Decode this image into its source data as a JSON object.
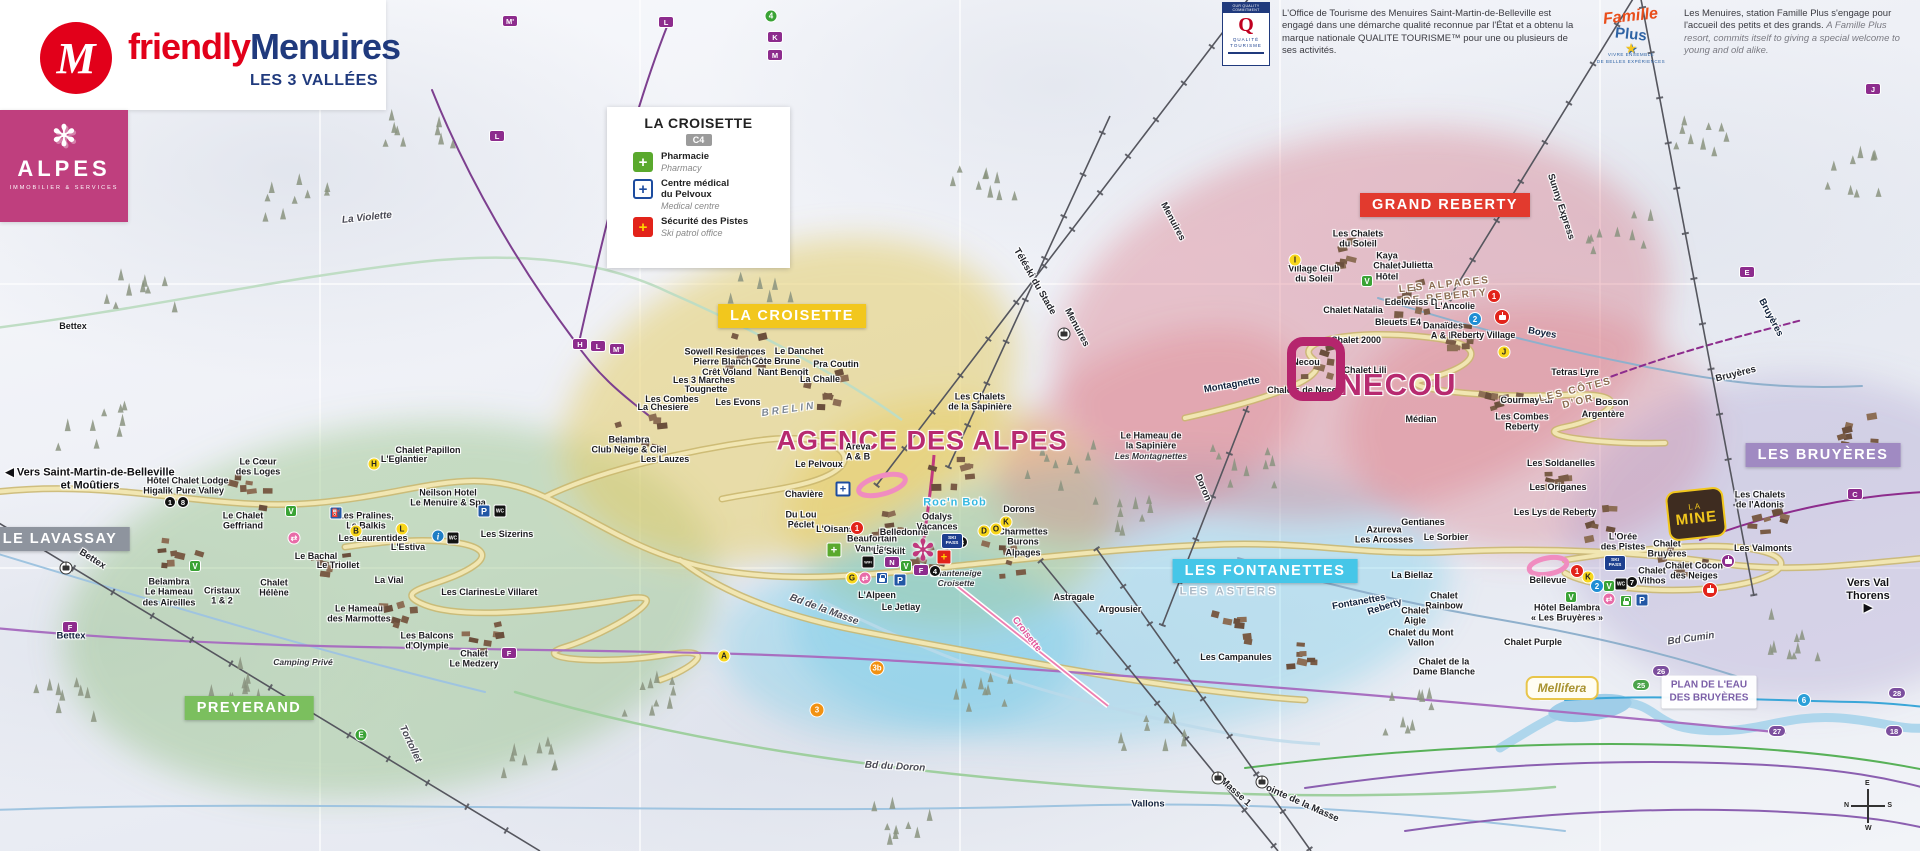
{
  "colors": {
    "brand_red": "#e2001a",
    "brand_blue": "#203a7d",
    "magenta": "#b72a70",
    "alpes_pink": "#bf3f7e",
    "banner_yellow": "#f2c71d",
    "banner_red": "#e23a2e",
    "banner_cyan": "#45c6e8",
    "banner_purple": "#a08ac2",
    "banner_green": "#7bbf5e",
    "banner_gray": "#8e949e",
    "pharmacy_green": "#5aa92d",
    "medical_blue": "#1d4c9f",
    "patrol_red": "#e2231a"
  },
  "brand": {
    "friendly": "friendly",
    "menuires": "Menuires",
    "m_initial": "M",
    "tagline": "LES 3 VALLÉES"
  },
  "alpes_card": {
    "flake": "✻",
    "word": "ALPES",
    "sub": "IMMOBILIER & SERVICES"
  },
  "legend": {
    "title": "LA CROISETTE",
    "grid_ref": "C4",
    "items": [
      {
        "icon": "pharmacy-cross",
        "glyph": "+",
        "fr": "Pharmacie",
        "en": "Pharmacy"
      },
      {
        "icon": "medical-cross",
        "glyph": "+",
        "fr": "Centre médical\ndu Pelvoux",
        "en": "Medical centre"
      },
      {
        "icon": "ski-patrol-cross",
        "glyph": "+",
        "fr": "Sécurité des Pistes",
        "en": "Ski patrol office"
      }
    ]
  },
  "info_qualite": {
    "logo_top": "OUR QUALITY COMMITMENT",
    "logo_q": "Q",
    "logo_name": "QUALITÉ TOURISME",
    "text": "L'Office de Tourisme des Menuires Saint-Martin-de-Belleville est engagé dans une démarche qualité reconnue par l'État et a obtenu la marque nationale QUALITE TOURISME™ pour une ou plusieurs de ses activités."
  },
  "info_famille": {
    "logo_script": "Famille",
    "logo_plus": "Plus",
    "logo_star": "★",
    "logo_sub": "VIVRE ENSEMBLE\nDE BELLES EXPÉRIENCES",
    "text_fr": "Les Menuires, station Famille Plus s'engage pour l'accueil des petits et des grands.",
    "text_en": "A Famille Plus resort, commits itself to giving a special welcome to young and old alike."
  },
  "special": {
    "plan_eau": "PLAN DE L'EAU\nDES BRUYÈRES",
    "mellifera": "Mellifera",
    "la_mine_top": "LA",
    "la_mine_main": "MINE",
    "compass": {
      "top": "E",
      "right": "S",
      "bottom": "W",
      "left": "N"
    },
    "agence_marker": "✻"
  },
  "zone_banners": [
    {
      "t": "LA CROISETTE",
      "x": 792,
      "y": 316,
      "bg": "#f2c71d"
    },
    {
      "t": "GRAND REBERTY",
      "x": 1445,
      "y": 205,
      "bg": "#e23a2e"
    },
    {
      "t": "LES FONTANETTES",
      "x": 1265,
      "y": 571,
      "bg": "#45c6e8"
    },
    {
      "t": "LES BRUYÈRES",
      "x": 1823,
      "y": 455,
      "bg": "#a08ac2"
    },
    {
      "t": "PREYERAND",
      "x": 249,
      "y": 708,
      "bg": "#7bbf5e"
    },
    {
      "t": "LE LAVASSAY",
      "x": 60,
      "y": 539,
      "bg": "#8e949e"
    }
  ],
  "map_labels": [
    {
      "t": "AGENCE DES ALPES",
      "x": 922,
      "y": 441,
      "c": "big",
      "fs": 27
    },
    {
      "t": "NECOU",
      "x": 1398,
      "y": 385,
      "c": "big",
      "fs": 31
    },
    {
      "t": "◀ Vers Saint-Martin-de-Belleville\net Moûtiers",
      "x": 90,
      "y": 479,
      "c": "dir"
    },
    {
      "t": "Vers Val Thorens ▶",
      "x": 1868,
      "y": 596,
      "c": "dir"
    },
    {
      "t": "Hôtel\nHigalik",
      "x": 158,
      "y": 486
    },
    {
      "t": "Chalet Lodge\nPure Valley",
      "x": 200,
      "y": 486
    },
    {
      "t": "Le Cœur\ndes Loges",
      "x": 258,
      "y": 467
    },
    {
      "t": "Chalet Papillon",
      "x": 428,
      "y": 450
    },
    {
      "t": "L'Eglantier",
      "x": 404,
      "y": 459
    },
    {
      "t": "Neilson Hotel\nLe Menuire & Spa",
      "x": 448,
      "y": 498
    },
    {
      "t": "Le Chalet\nGeffriand",
      "x": 243,
      "y": 521
    },
    {
      "t": "Les Pralines,\nLe Balkis",
      "x": 366,
      "y": 521
    },
    {
      "t": "Les Laurentides",
      "x": 373,
      "y": 538
    },
    {
      "t": "L'Estiva",
      "x": 408,
      "y": 547
    },
    {
      "t": "Le Bachal",
      "x": 316,
      "y": 556
    },
    {
      "t": "Le Triollet",
      "x": 338,
      "y": 565
    },
    {
      "t": "La Vial",
      "x": 389,
      "y": 580
    },
    {
      "t": "Les Clarines",
      "x": 468,
      "y": 592
    },
    {
      "t": "Le Villaret",
      "x": 516,
      "y": 592
    },
    {
      "t": "Les Sizerins",
      "x": 507,
      "y": 534
    },
    {
      "t": "Belambra\nLe Hameau\ndes Aireilles",
      "x": 169,
      "y": 592
    },
    {
      "t": "Cristaux\n1 & 2",
      "x": 222,
      "y": 596
    },
    {
      "t": "Chalet\nHélène",
      "x": 274,
      "y": 588
    },
    {
      "t": "Le Hameau\ndes Marmottes",
      "x": 359,
      "y": 614
    },
    {
      "t": "Les Balcons\nd'Olympie",
      "x": 427,
      "y": 641
    },
    {
      "t": "Chalet\nLe Medzery",
      "x": 474,
      "y": 659
    },
    {
      "t": "Camping Privé",
      "x": 303,
      "y": 663,
      "c": "pi"
    },
    {
      "t": "Bettex",
      "x": 73,
      "y": 326
    },
    {
      "t": "Bettex",
      "x": 71,
      "y": 637,
      "c": "piste"
    },
    {
      "t": "Bettex",
      "x": 92,
      "y": 560,
      "c": "lift",
      "r": 32
    },
    {
      "t": "Tortollet",
      "x": 410,
      "y": 744,
      "c": "road",
      "r": 65
    },
    {
      "t": "La Violette",
      "x": 367,
      "y": 218,
      "c": "road",
      "r": -6
    },
    {
      "t": "Sowell Residences\nPierre Blanche",
      "x": 725,
      "y": 357
    },
    {
      "t": "Crêt Voland",
      "x": 727,
      "y": 372
    },
    {
      "t": "Côte Brune",
      "x": 776,
      "y": 361
    },
    {
      "t": "Le Danchet",
      "x": 799,
      "y": 351
    },
    {
      "t": "Nant Benoît",
      "x": 783,
      "y": 372
    },
    {
      "t": "Pra Coutin",
      "x": 836,
      "y": 364
    },
    {
      "t": "La Challe",
      "x": 820,
      "y": 379
    },
    {
      "t": "Les 3 Marches",
      "x": 704,
      "y": 380
    },
    {
      "t": "Tougnette",
      "x": 706,
      "y": 389
    },
    {
      "t": "Les Combes",
      "x": 672,
      "y": 399
    },
    {
      "t": "La Chesiere",
      "x": 663,
      "y": 407
    },
    {
      "t": "Les Evons",
      "x": 738,
      "y": 402
    },
    {
      "t": "BRELIN",
      "x": 789,
      "y": 410,
      "c": "areaGray",
      "r": -8
    },
    {
      "t": "Belambra\nClub Neige & Ciel",
      "x": 629,
      "y": 445
    },
    {
      "t": "Les Lauzes",
      "x": 665,
      "y": 459
    },
    {
      "t": "Le Pelvoux",
      "x": 819,
      "y": 464
    },
    {
      "t": "Areva\nA & B",
      "x": 858,
      "y": 452
    },
    {
      "t": "Chavière",
      "x": 804,
      "y": 494
    },
    {
      "t": "Du Lou\nPéclet",
      "x": 801,
      "y": 520
    },
    {
      "t": "L'Oisans",
      "x": 835,
      "y": 529
    },
    {
      "t": "Beaufortain\nVanoise",
      "x": 872,
      "y": 544
    },
    {
      "t": "Le Skilt",
      "x": 889,
      "y": 551
    },
    {
      "t": "Belledonne",
      "x": 904,
      "y": 532
    },
    {
      "t": "Odalys\nVacances",
      "x": 937,
      "y": 522
    },
    {
      "t": "Dorons",
      "x": 1019,
      "y": 509
    },
    {
      "t": "Charmettes\nBurons\nAlpages",
      "x": 1023,
      "y": 542
    },
    {
      "t": "Chanteneige\nCroisette",
      "x": 956,
      "y": 579,
      "c": "pi"
    },
    {
      "t": "L'Alpeen",
      "x": 877,
      "y": 595
    },
    {
      "t": "Le Jetlay",
      "x": 901,
      "y": 607
    },
    {
      "t": "Roc'n Bob",
      "x": 955,
      "y": 503,
      "c": "fun"
    },
    {
      "t": "Bd de la Masse",
      "x": 824,
      "y": 610,
      "c": "road",
      "r": 20
    },
    {
      "t": "Bd du Doron",
      "x": 895,
      "y": 767,
      "c": "road",
      "r": 3
    },
    {
      "t": "Croisette",
      "x": 1026,
      "y": 635,
      "c": "liftPink",
      "r": 52
    },
    {
      "t": "Menuires",
      "x": 1172,
      "y": 222,
      "c": "lift",
      "r": 62
    },
    {
      "t": "Menuires",
      "x": 1076,
      "y": 328,
      "c": "lift",
      "r": 62
    },
    {
      "t": "Téléski du Stade",
      "x": 1034,
      "y": 282,
      "c": "lift",
      "r": 60
    },
    {
      "t": "Montagnette",
      "x": 1232,
      "y": 386,
      "c": "piste",
      "r": -10
    },
    {
      "t": "Doron",
      "x": 1202,
      "y": 488,
      "c": "lift",
      "r": 67
    },
    {
      "t": "Astragale",
      "x": 1074,
      "y": 597
    },
    {
      "t": "Argousier",
      "x": 1120,
      "y": 609
    },
    {
      "t": "LES ASTERS",
      "x": 1229,
      "y": 592,
      "c": "areaOutline"
    },
    {
      "t": "Les Campanules",
      "x": 1236,
      "y": 657
    },
    {
      "t": "Fontanettes",
      "x": 1359,
      "y": 603,
      "c": "piste",
      "r": -10
    },
    {
      "t": "Reberty",
      "x": 1385,
      "y": 608,
      "c": "piste",
      "r": -18
    },
    {
      "t": "Vallons",
      "x": 1148,
      "y": 805,
      "c": "piste"
    },
    {
      "t": "Masse 1",
      "x": 1235,
      "y": 793,
      "c": "lift",
      "r": 42
    },
    {
      "t": "Pointe de la Masse",
      "x": 1299,
      "y": 803,
      "c": "lift",
      "r": 24
    },
    {
      "t": "Les Chalets\nde la Sapinière",
      "x": 980,
      "y": 402
    },
    {
      "t": "Le Hameau de\nla Sapinière",
      "x": 1151,
      "y": 441
    },
    {
      "t": "Les Montagnettes",
      "x": 1151,
      "y": 457,
      "c": "pi"
    },
    {
      "t": "Les Chalets\ndu Soleil",
      "x": 1358,
      "y": 239
    },
    {
      "t": "Kaya\nChalet\nHôtel",
      "x": 1387,
      "y": 266
    },
    {
      "t": "Julietta",
      "x": 1417,
      "y": 265
    },
    {
      "t": "Village Club\ndu Soleil",
      "x": 1314,
      "y": 274
    },
    {
      "t": "LES ALPAGES\nDE REBERTY",
      "x": 1445,
      "y": 291,
      "c": "areaBrown",
      "r": -6
    },
    {
      "t": "Chalet Natalia",
      "x": 1353,
      "y": 310
    },
    {
      "t": "Edelweiss D",
      "x": 1411,
      "y": 302
    },
    {
      "t": "L'Ancolie",
      "x": 1455,
      "y": 306
    },
    {
      "t": "Bleuets E4",
      "x": 1398,
      "y": 322
    },
    {
      "t": "Danaïdes\nA & B",
      "x": 1443,
      "y": 331
    },
    {
      "t": "Reberty Village",
      "x": 1483,
      "y": 335
    },
    {
      "t": "Chalet 2000",
      "x": 1356,
      "y": 340
    },
    {
      "t": "Chalet Lili",
      "x": 1365,
      "y": 370
    },
    {
      "t": "Necou",
      "x": 1306,
      "y": 362
    },
    {
      "t": "Chalets de Necou",
      "x": 1305,
      "y": 390
    },
    {
      "t": "Tetras Lyre",
      "x": 1575,
      "y": 372
    },
    {
      "t": "Courmayeur",
      "x": 1527,
      "y": 400
    },
    {
      "t": "LES CÔTES\nD'OR",
      "x": 1577,
      "y": 396,
      "c": "areaBrown",
      "r": -14
    },
    {
      "t": "Bosson",
      "x": 1612,
      "y": 402
    },
    {
      "t": "Argentère",
      "x": 1603,
      "y": 414
    },
    {
      "t": "Les Combes\nReberty",
      "x": 1522,
      "y": 422
    },
    {
      "t": "Médian",
      "x": 1421,
      "y": 419
    },
    {
      "t": "Boyes",
      "x": 1542,
      "y": 334,
      "c": "piste",
      "r": 10
    },
    {
      "t": "Sunny Express",
      "x": 1560,
      "y": 207,
      "c": "lift",
      "r": 72
    },
    {
      "t": "Bruyères",
      "x": 1770,
      "y": 318,
      "c": "piste",
      "r": 62
    },
    {
      "t": "Bruyères",
      "x": 1736,
      "y": 375,
      "c": "lift",
      "r": -14
    },
    {
      "t": "Les Soldanelles",
      "x": 1561,
      "y": 463
    },
    {
      "t": "Les Origanes",
      "x": 1558,
      "y": 487
    },
    {
      "t": "Les Lys de Reberty",
      "x": 1555,
      "y": 512
    },
    {
      "t": "Gentianes",
      "x": 1423,
      "y": 522
    },
    {
      "t": "Azureva\nLes Arcosses",
      "x": 1384,
      "y": 535
    },
    {
      "t": "Le Sorbier",
      "x": 1446,
      "y": 537
    },
    {
      "t": "La Biellaz",
      "x": 1412,
      "y": 575
    },
    {
      "t": "Chalet\nRainbow",
      "x": 1444,
      "y": 601
    },
    {
      "t": "Chalet\nAigle",
      "x": 1415,
      "y": 616
    },
    {
      "t": "Chalet du Mont\nVallon",
      "x": 1421,
      "y": 638
    },
    {
      "t": "Chalet de la\nDame Blanche",
      "x": 1444,
      "y": 667
    },
    {
      "t": "Bellevue",
      "x": 1548,
      "y": 580
    },
    {
      "t": "L'Orée\ndes Pistes",
      "x": 1623,
      "y": 542
    },
    {
      "t": "Chalet\nBruyères",
      "x": 1667,
      "y": 549
    },
    {
      "t": "Chalet\nVithos",
      "x": 1652,
      "y": 576
    },
    {
      "t": "Chalet Cocon\ndes Neiges",
      "x": 1694,
      "y": 571
    },
    {
      "t": "Les Valmonts",
      "x": 1763,
      "y": 548
    },
    {
      "t": "Hôtel Belambra\n« Les Bruyères »",
      "x": 1567,
      "y": 613
    },
    {
      "t": "Chalet Purple",
      "x": 1533,
      "y": 642
    },
    {
      "t": "Les Chalets\nde l'Adonis",
      "x": 1760,
      "y": 500
    },
    {
      "t": "Bd Cumin",
      "x": 1691,
      "y": 639,
      "c": "road",
      "r": -8
    }
  ],
  "map_badges": [
    {
      "k": "prect",
      "t": "M'",
      "x": 510,
      "y": 21
    },
    {
      "k": "prect",
      "t": "L",
      "x": 666,
      "y": 22
    },
    {
      "k": "prect",
      "t": "L",
      "x": 497,
      "y": 136
    },
    {
      "k": "prect",
      "t": "H",
      "x": 580,
      "y": 344
    },
    {
      "k": "prect",
      "t": "L",
      "x": 598,
      "y": 346
    },
    {
      "k": "prect",
      "t": "M'",
      "x": 617,
      "y": 349
    },
    {
      "k": "prect",
      "t": "J",
      "x": 1873,
      "y": 89
    },
    {
      "k": "prect",
      "t": "E",
      "x": 1747,
      "y": 272
    },
    {
      "k": "prect",
      "t": "C",
      "x": 1855,
      "y": 494
    },
    {
      "k": "prect",
      "t": "F",
      "x": 70,
      "y": 627
    },
    {
      "k": "prect",
      "t": "F",
      "x": 509,
      "y": 653
    },
    {
      "k": "prect",
      "t": "K",
      "x": 775,
      "y": 37
    },
    {
      "k": "prect",
      "t": "M",
      "x": 775,
      "y": 55
    },
    {
      "k": "prect",
      "t": "N",
      "x": 892,
      "y": 562
    },
    {
      "k": "prect",
      "t": "F",
      "x": 921,
      "y": 570
    },
    {
      "k": "gcirc",
      "t": "4",
      "x": 771,
      "y": 16
    },
    {
      "k": "gcirc",
      "t": "E",
      "x": 361,
      "y": 735
    },
    {
      "k": "gsq",
      "t": "V",
      "x": 291,
      "y": 511
    },
    {
      "k": "gsq",
      "t": "V",
      "x": 195,
      "y": 566
    },
    {
      "k": "gsq",
      "t": "V",
      "x": 1367,
      "y": 281
    },
    {
      "k": "gsq",
      "t": "V",
      "x": 906,
      "y": 566
    },
    {
      "k": "gsq",
      "t": "V",
      "x": 1571,
      "y": 597
    },
    {
      "k": "gsq",
      "t": "V",
      "x": 1609,
      "y": 586
    },
    {
      "k": "ycirc",
      "t": "H",
      "x": 374,
      "y": 464
    },
    {
      "k": "ycirc",
      "t": "B",
      "x": 356,
      "y": 531
    },
    {
      "k": "ycirc",
      "t": "L",
      "x": 402,
      "y": 529
    },
    {
      "k": "ycirc",
      "t": "I",
      "x": 1295,
      "y": 260
    },
    {
      "k": "ycirc",
      "t": "J",
      "x": 1504,
      "y": 352
    },
    {
      "k": "ycirc",
      "t": "A",
      "x": 724,
      "y": 656
    },
    {
      "k": "ycirc",
      "t": "D",
      "x": 984,
      "y": 531
    },
    {
      "k": "ycirc",
      "t": "O",
      "x": 996,
      "y": 529
    },
    {
      "k": "ycirc",
      "t": "K",
      "x": 1006,
      "y": 522
    },
    {
      "k": "ycirc",
      "t": "K",
      "x": 1588,
      "y": 577
    },
    {
      "k": "ycirc",
      "t": "G",
      "x": 852,
      "y": 578
    },
    {
      "k": "rcirc",
      "t": "1",
      "x": 857,
      "y": 528
    },
    {
      "k": "rcirc",
      "t": "1",
      "x": 1494,
      "y": 296
    },
    {
      "k": "rcirc",
      "t": "1",
      "x": 1577,
      "y": 571
    },
    {
      "k": "bcirc",
      "t": "2",
      "x": 1475,
      "y": 319
    },
    {
      "k": "bcirc",
      "t": "2",
      "x": 1597,
      "y": 586
    },
    {
      "k": "kcirc",
      "t": "3",
      "x": 962,
      "y": 542
    },
    {
      "k": "kcirc",
      "t": "4",
      "x": 935,
      "y": 571
    },
    {
      "k": "kcirc",
      "t": "7",
      "x": 1632,
      "y": 582
    },
    {
      "k": "kcirc",
      "t": "1",
      "x": 170,
      "y": 502
    },
    {
      "k": "kcirc",
      "t": "8",
      "x": 183,
      "y": 502
    },
    {
      "k": "ocirc",
      "t": "3",
      "x": 817,
      "y": 710
    },
    {
      "k": "ocirc",
      "t": "3b",
      "x": 877,
      "y": 668
    },
    {
      "k": "rpurp",
      "t": "26",
      "x": 1661,
      "y": 671
    },
    {
      "k": "rpurp",
      "t": "27",
      "x": 1777,
      "y": 731
    },
    {
      "k": "rpurp",
      "t": "28",
      "x": 1897,
      "y": 693
    },
    {
      "k": "rpurp",
      "t": "18",
      "x": 1894,
      "y": 731
    },
    {
      "k": "rgreen",
      "t": "25",
      "x": 1641,
      "y": 685
    },
    {
      "k": "rblue",
      "t": "6",
      "x": 1804,
      "y": 700
    },
    {
      "k": "i",
      "t": "i",
      "x": 438,
      "y": 536
    },
    {
      "k": "P",
      "t": "P",
      "x": 484,
      "y": 511
    },
    {
      "k": "P",
      "t": "P",
      "x": 900,
      "y": 580
    },
    {
      "k": "P",
      "t": "P",
      "x": 1642,
      "y": 600
    },
    {
      "k": "fuel",
      "t": "⛽",
      "x": 336,
      "y": 513
    },
    {
      "k": "wc",
      "t": "WC",
      "x": 500,
      "y": 511
    },
    {
      "k": "wc",
      "t": "WC",
      "x": 453,
      "y": 538
    },
    {
      "k": "wc",
      "t": "WC",
      "x": 1621,
      "y": 584
    },
    {
      "k": "wc",
      "t": "WC",
      "x": 1545,
      "y": 694
    },
    {
      "k": "wifi",
      "t": "WiFi",
      "x": 868,
      "y": 562
    },
    {
      "k": "skipass",
      "t": "SKI\nPASS",
      "x": 952,
      "y": 541
    },
    {
      "k": "skipass",
      "t": "SKI\nPASS",
      "x": 1615,
      "y": 563
    },
    {
      "k": "gondr",
      "x": 1502,
      "y": 317
    },
    {
      "k": "gondr",
      "x": 1710,
      "y": 590
    },
    {
      "k": "gondp",
      "x": 1728,
      "y": 561
    },
    {
      "k": "gondw",
      "x": 1064,
      "y": 334
    },
    {
      "k": "gondw",
      "x": 1218,
      "y": 778
    },
    {
      "k": "gondw",
      "x": 1262,
      "y": 782
    },
    {
      "k": "gondw",
      "x": 66,
      "y": 568
    },
    {
      "k": "pink",
      "t": "⇄",
      "x": 294,
      "y": 538
    },
    {
      "k": "pink",
      "t": "⇄",
      "x": 865,
      "y": 578
    },
    {
      "k": "pink",
      "t": "⇄",
      "x": 1609,
      "y": 599
    },
    {
      "k": "lockb",
      "x": 882,
      "y": 578
    },
    {
      "k": "lockg",
      "x": 1626,
      "y": 601
    },
    {
      "k": "crossg",
      "t": "+",
      "x": 834,
      "y": 550
    },
    {
      "k": "crossb",
      "t": "+",
      "x": 843,
      "y": 489
    },
    {
      "k": "crossr",
      "t": "+",
      "x": 944,
      "y": 557
    }
  ]
}
